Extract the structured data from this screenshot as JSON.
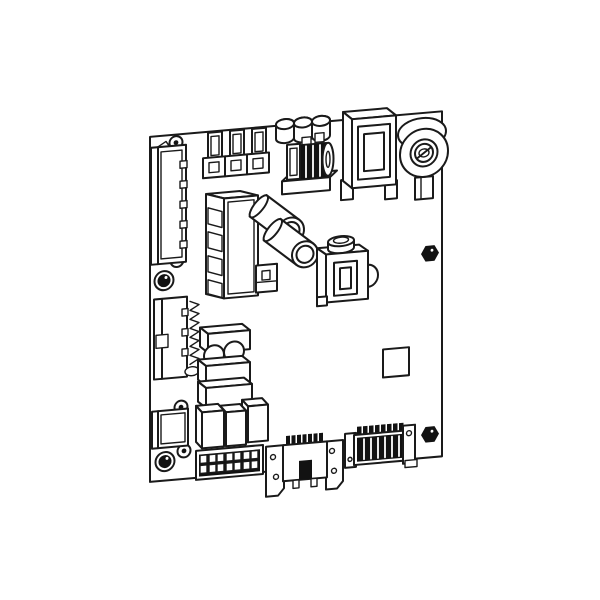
{
  "figure": {
    "title": "Printed circuit board assembly — isometric technical line drawing",
    "type": "technical-illustration",
    "text_labels": []
  },
  "colors": {
    "bg": "#ffffff",
    "line": "#1a1a1a",
    "fill": "#ffffff",
    "solid": "#121212"
  },
  "components": [
    {
      "id": "pcb-board",
      "label": "PCB board outline"
    },
    {
      "id": "mounting-hole",
      "label": "Mounting screw holes (4)"
    },
    {
      "id": "screw-head",
      "label": "Black screw heads, left edge (2)"
    },
    {
      "id": "hex-nut",
      "label": "Hex standoff nuts, right side (2)"
    },
    {
      "id": "edge-connector-top-left",
      "label": "Vertical pin connector, upper left edge"
    },
    {
      "id": "edge-connector-mid-left",
      "label": "Vertical pin connector, middle left edge"
    },
    {
      "id": "edge-connector-low-left",
      "label": "Small connector housing, lower left edge"
    },
    {
      "id": "heatsink-fins",
      "label": "Finned heatsink / pin row"
    },
    {
      "id": "spade-terminal",
      "label": "Blade (faston) terminals, top edge (3)"
    },
    {
      "id": "top-capacitor",
      "label": "Capacitor cans peeking over top edge (3)"
    },
    {
      "id": "inductor-coil",
      "label": "Wound inductor choke on base plate"
    },
    {
      "id": "power-relay",
      "label": "Large relay with window frame, top right"
    },
    {
      "id": "rotary-buzzer",
      "label": "Round buzzer / potentiometer with screw slot"
    },
    {
      "id": "relay-tall",
      "label": "Tall relay / connector housing, center left"
    },
    {
      "id": "cyl-capacitor",
      "label": "Cylindrical electrolytic capacitors (2)"
    },
    {
      "id": "small-transformer",
      "label": "Small transformer with cap cylinder and dome"
    },
    {
      "id": "ic-footprint",
      "label": "Square IC outline"
    },
    {
      "id": "component-stack",
      "label": "Stacked box components with two round capacitors"
    },
    {
      "id": "relay-bank",
      "label": "Bank of three relays"
    },
    {
      "id": "terminal-strip",
      "label": "Screw terminal block 2 x 7"
    },
    {
      "id": "bottom-center-connector",
      "label": "Bracketed header connector, bottom center"
    },
    {
      "id": "bottom-right-connector",
      "label": "Hatched header connector, bottom right"
    }
  ]
}
